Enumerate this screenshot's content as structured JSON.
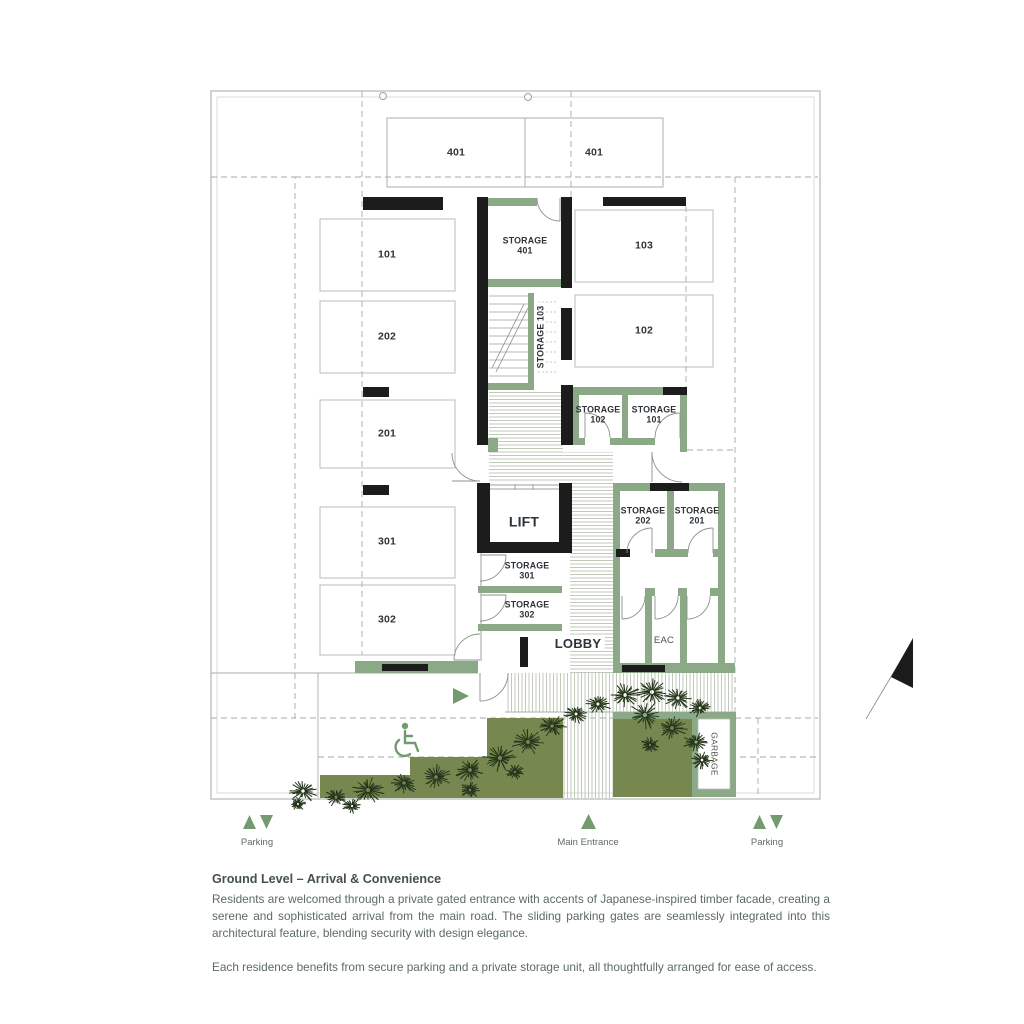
{
  "colors": {
    "sage_wall": "#8CA987",
    "olive_landscape": "#76874F",
    "black_wall": "#1c1c1c",
    "plan_line_gray": "#b3b8b5",
    "dash_gray": "#a3aca7",
    "hatch_line": "#bac4b2",
    "label_dark": "#2d3338",
    "body_text": "#5c6b61",
    "icon_green": "#749b70"
  },
  "plan": {
    "labels": [
      {
        "name": "unit-401-left",
        "text": "401",
        "x": 456,
        "y": 153,
        "size": 10.5
      },
      {
        "name": "unit-401-right",
        "text": "401",
        "x": 594,
        "y": 153,
        "size": 10.5
      },
      {
        "name": "stall-101",
        "text": "101",
        "x": 387,
        "y": 255,
        "size": 10.5
      },
      {
        "name": "stall-202",
        "text": "202",
        "x": 387,
        "y": 337,
        "size": 10.5
      },
      {
        "name": "stall-201",
        "text": "201",
        "x": 387,
        "y": 434,
        "size": 10.5
      },
      {
        "name": "stall-301",
        "text": "301",
        "x": 387,
        "y": 542,
        "size": 10.5
      },
      {
        "name": "stall-302",
        "text": "302",
        "x": 387,
        "y": 620,
        "size": 10.5
      },
      {
        "name": "stall-103",
        "text": "103",
        "x": 644,
        "y": 246,
        "size": 10.5
      },
      {
        "name": "stall-102",
        "text": "102",
        "x": 644,
        "y": 331,
        "size": 10.5
      },
      {
        "name": "room-storage-401",
        "text": "STORAGE\n401",
        "x": 525,
        "y": 246,
        "size": 8.8
      },
      {
        "name": "room-storage-103",
        "text": "STORAGE 103",
        "x": 541,
        "y": 337,
        "size": 8.8,
        "rot": -90,
        "chip": true
      },
      {
        "name": "room-storage-102",
        "text": "STORAGE\n102",
        "x": 598,
        "y": 415,
        "size": 8.8
      },
      {
        "name": "room-storage-101",
        "text": "STORAGE\n101",
        "x": 654,
        "y": 415,
        "size": 8.8
      },
      {
        "name": "room-storage-202",
        "text": "STORAGE\n202",
        "x": 643,
        "y": 516,
        "size": 8.8
      },
      {
        "name": "room-storage-201",
        "text": "STORAGE\n201",
        "x": 697,
        "y": 516,
        "size": 8.8
      },
      {
        "name": "room-lift",
        "text": "LIFT",
        "x": 524,
        "y": 522,
        "size": 14
      },
      {
        "name": "room-storage-301",
        "text": "STORAGE\n301",
        "x": 527,
        "y": 571,
        "size": 8.8
      },
      {
        "name": "room-storage-302",
        "text": "STORAGE\n302",
        "x": 527,
        "y": 610,
        "size": 8.8
      },
      {
        "name": "room-lobby",
        "text": "LOBBY",
        "x": 578,
        "y": 644,
        "size": 13,
        "chip": true
      },
      {
        "name": "room-eac",
        "text": "EAC",
        "x": 664,
        "y": 641,
        "size": 9.5,
        "normal": true
      },
      {
        "name": "room-garbage",
        "text": "GARBAGE",
        "x": 714,
        "y": 754,
        "size": 8.5,
        "rot": 90,
        "normal": true
      }
    ]
  },
  "legend": {
    "items": [
      {
        "name": "legend-parking-left",
        "label": "Parking",
        "x": 257,
        "arrows": "both"
      },
      {
        "name": "legend-main-entrance",
        "label": "Main Entrance",
        "x": 588,
        "arrows": "up"
      },
      {
        "name": "legend-parking-right",
        "label": "Parking",
        "x": 767,
        "arrows": "both"
      }
    ]
  },
  "description": {
    "heading": "Ground Level – Arrival & Convenience",
    "paragraphs": [
      "Residents are welcomed through a private gated entrance with accents of Japanese-inspired timber facade, creating a serene and sophisticated arrival from the main road. The sliding parking gates are seamlessly integrated into this architectural feature, blending security with design elegance.",
      "Each residence benefits from secure parking and a private storage unit, all thoughtfully arranged for ease of access."
    ]
  }
}
